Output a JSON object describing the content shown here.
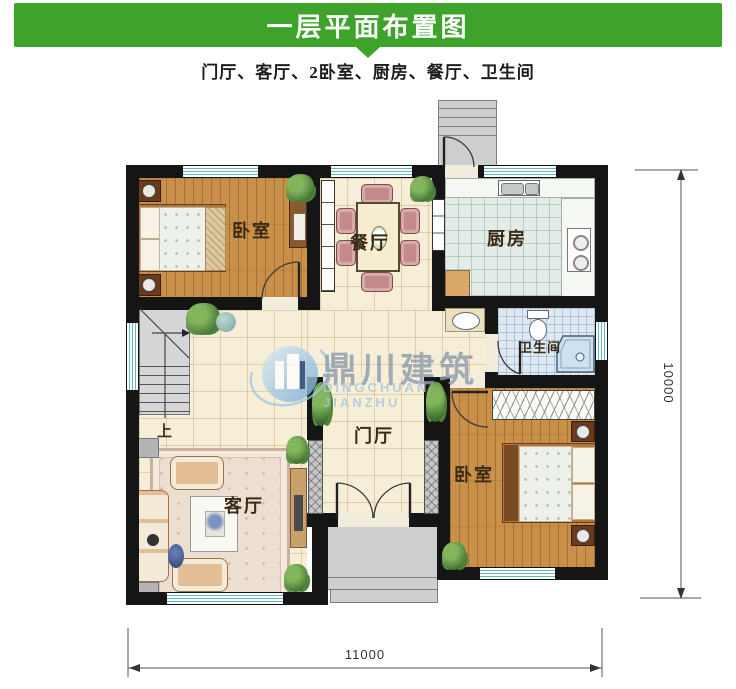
{
  "header": {
    "title": "一层平面布置图",
    "background_color": "#3da32b",
    "text_color": "#ffffff"
  },
  "subtitle": "门厅、客厅、2卧室、厨房、餐厅、卫生间",
  "watermark": {
    "name_cn": "鼎川建筑",
    "name_en": "DINGCHUAN JIANZHU"
  },
  "rooms": {
    "bedroom_top_left": {
      "label": "卧室"
    },
    "dining": {
      "label": "餐厅"
    },
    "kitchen": {
      "label": "厨房"
    },
    "bathroom": {
      "label": "卫生间"
    },
    "entry_hall": {
      "label": "门厅"
    },
    "living": {
      "label": "客厅"
    },
    "bedroom_bottom_right": {
      "label": "卧室"
    }
  },
  "stairs": {
    "direction_label": "上"
  },
  "dimensions": {
    "bottom_width": "11000",
    "right_height": "10000"
  },
  "colors": {
    "header_green": "#3da32b",
    "wall": "#151515",
    "window_glass": "#64b8c0",
    "wood_floor": "#c9904a",
    "hall_tile": "#f7eed8",
    "kitchen_tile": "#e3ece6",
    "bath_tile": "#dfe9f2",
    "porch_gray": "#cdced0"
  }
}
